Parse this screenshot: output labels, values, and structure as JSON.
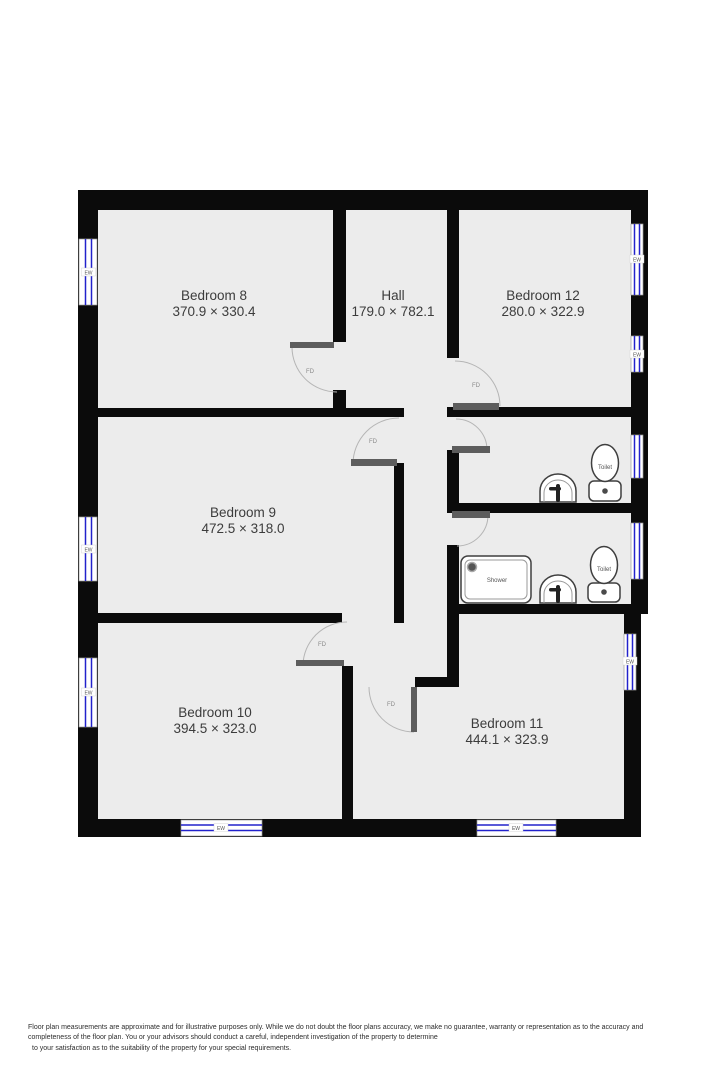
{
  "plan": {
    "rooms": [
      {
        "id": "bedroom-8",
        "name": "Bedroom 8",
        "dimensions": "370.9 × 330.4"
      },
      {
        "id": "hall",
        "name": "Hall",
        "dimensions": "179.0 × 782.1"
      },
      {
        "id": "bedroom-12",
        "name": "Bedroom 12",
        "dimensions": "280.0 × 322.9"
      },
      {
        "id": "bedroom-9",
        "name": "Bedroom 9",
        "dimensions": "472.5 × 318.0"
      },
      {
        "id": "bedroom-10",
        "name": "Bedroom 10",
        "dimensions": "394.5 × 323.0"
      },
      {
        "id": "bedroom-11",
        "name": "Bedroom 11",
        "dimensions": "444.1 × 323.9"
      }
    ],
    "labels": {
      "fire_door": "FD",
      "external_window": "EW",
      "toilet": "Toilet",
      "shower": "Shower"
    },
    "colors": {
      "wall": "#0b0b0b",
      "floor": "#ececec",
      "window_glass": "#2222cc",
      "door_leaf": "#5d5d5d",
      "door_arc": "#b5b5b5",
      "room_text": "#3c3c3c"
    }
  },
  "footer": {
    "line1": "Floor plan measurements are approximate and for illustrative purposes only. While we do not doubt the floor plans accuracy, we make no guarantee, warranty or representation as to the accuracy and",
    "line2": "completeness of the floor plan. You or your advisors should conduct a careful, independent investigation of the property to determine",
    "line3": "to your satisfaction as to the suitability of the property for your special requirements."
  }
}
